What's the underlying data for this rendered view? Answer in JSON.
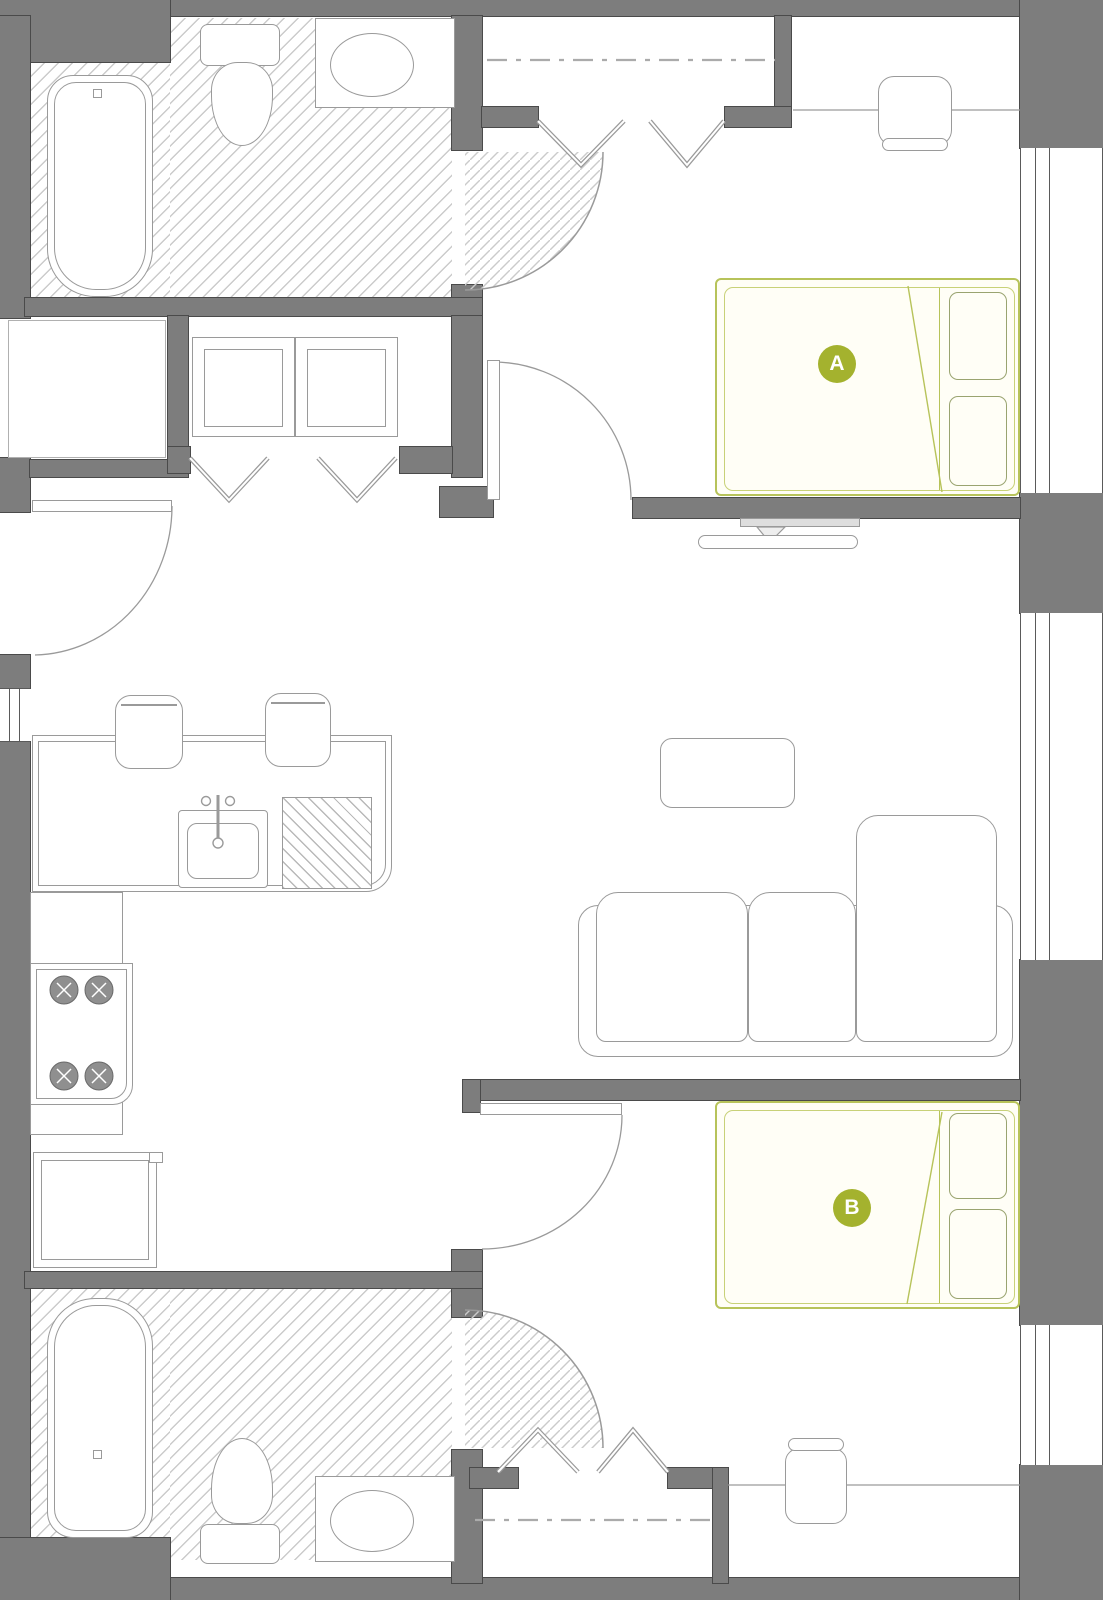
{
  "floor_plan": {
    "bedroom_labels": [
      {
        "label": "A"
      },
      {
        "label": "B"
      }
    ],
    "colors": {
      "wall": "#7d7d7d",
      "wall_edge": "#4a4a4a",
      "furniture_line": "#9a9a9a",
      "floor_hatch": "#cbcbcb",
      "unit_badge_green": "#a4b22e",
      "bed_outline_green": "#b7c35a"
    },
    "regions": [
      "bathroom-top",
      "laundry-closet",
      "entry-alcove",
      "closet-bedroom-a",
      "bedroom-a",
      "kitchen",
      "living-room",
      "bedroom-b",
      "closet-bedroom-b",
      "bathroom-bottom"
    ],
    "fixtures": [
      "bathtub",
      "toilet",
      "vanity-sink",
      "washer",
      "dryer",
      "bifold-doors",
      "door-swing",
      "double-bed",
      "pillows",
      "desk",
      "desk-chair",
      "window",
      "kitchen-counter",
      "bar-stool",
      "kitchen-sink",
      "dishwasher",
      "range-burners",
      "refrigerator",
      "coffee-table",
      "sofa-with-chaise",
      "tv-console",
      "closet-rod"
    ]
  }
}
